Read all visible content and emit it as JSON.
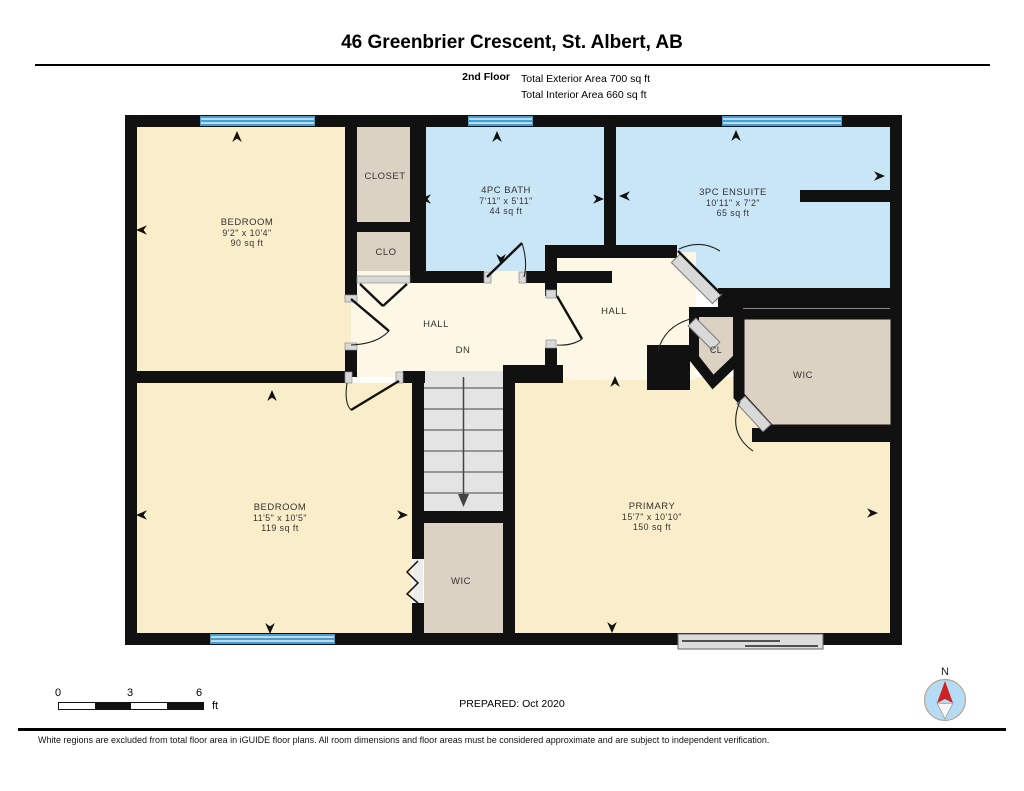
{
  "header": {
    "title": "46 Greenbrier Crescent, St. Albert, AB",
    "floor_label": "2nd Floor",
    "exterior_area": "Total Exterior Area 700 sq ft",
    "interior_area": "Total Interior Area 660 sq ft"
  },
  "plan": {
    "colors": {
      "wall": "#111111",
      "room": "#faedca",
      "hall": "#fdf8e6",
      "wet": "#c9e6f7",
      "closet": "#dcd2c3",
      "stairs": "#e4e4e4",
      "window": "#4a9ecf",
      "door": "#d9d9d9",
      "text": "#333333"
    },
    "rooms": {
      "bedroom1": {
        "name": "BEDROOM",
        "dims": "9'2\" x 10'4\"",
        "area": "90 sq ft"
      },
      "closet": {
        "name": "CLOSET"
      },
      "clo": {
        "name": "CLO"
      },
      "bath": {
        "name": "4PC BATH",
        "dims": "7'11\" x 5'11\"",
        "area": "44 sq ft"
      },
      "ensuite": {
        "name": "3PC ENSUITE",
        "dims": "10'11\" x 7'2\"",
        "area": "65 sq ft"
      },
      "hall_left": {
        "name": "HALL"
      },
      "stairs_dn": {
        "name": "DN"
      },
      "hall_right": {
        "name": "HALL"
      },
      "cl": {
        "name": "CL"
      },
      "wic_right": {
        "name": "WIC"
      },
      "bedroom2": {
        "name": "BEDROOM",
        "dims": "11'5\" x 10'5\"",
        "area": "119 sq ft"
      },
      "wic_bottom": {
        "name": "WIC"
      },
      "primary": {
        "name": "PRIMARY",
        "dims": "15'7\" x 10'10\"",
        "area": "150 sq ft"
      }
    }
  },
  "footer": {
    "scale": {
      "tick0": "0",
      "tick3": "3",
      "tick6": "6",
      "unit": "ft"
    },
    "prepared": "PREPARED: Oct 2020",
    "compass_n": "N",
    "disclaimer": "White regions are excluded from total floor area in iGUIDE floor plans. All room dimensions and floor areas must be considered approximate and are subject to independent verification."
  }
}
